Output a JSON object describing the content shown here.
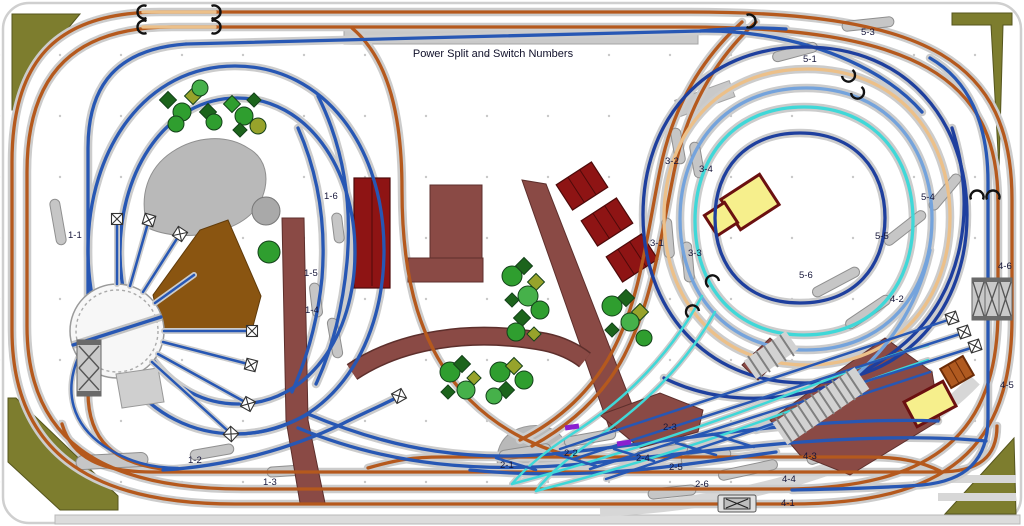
{
  "title": {
    "text": "Power Split and Switch Numbers"
  },
  "colors": {
    "orange": "#b5591d",
    "blue": "#2757b4",
    "dark_blue": "#1e3f9e",
    "tan": "#ecc089",
    "light_blue": "#74a3dc",
    "cyan": "#3fd8d8",
    "roadbed": "#cccccc",
    "olive": "#7d7d2e",
    "maroon": "#8a4a45",
    "dark_red": "#8e1414",
    "yellow": "#f6ef8c",
    "dirt": "#8a5511",
    "rock": "#b9b9b9",
    "tree_green": "#2f9e2f",
    "tree_dark": "#1c641c",
    "tree_olive": "#97a32b",
    "purple": "#8a1fd0",
    "label": "#16163a",
    "grid_dot": "#c8c8c8",
    "platform_gray": "#c6c6c6",
    "structure_gray": "#c9c9c9"
  },
  "switch_labels": [
    {
      "id": "1-1",
      "x": 68,
      "y": 238
    },
    {
      "id": "1-2",
      "x": 188,
      "y": 463
    },
    {
      "id": "1-3",
      "x": 263,
      "y": 485
    },
    {
      "id": "1-4",
      "x": 305,
      "y": 313
    },
    {
      "id": "1-5",
      "x": 304,
      "y": 276
    },
    {
      "id": "1-6",
      "x": 324,
      "y": 199
    },
    {
      "id": "2-1",
      "x": 500,
      "y": 468
    },
    {
      "id": "2-2",
      "x": 564,
      "y": 456
    },
    {
      "id": "2-3",
      "x": 663,
      "y": 430
    },
    {
      "id": "2-4",
      "x": 636,
      "y": 461
    },
    {
      "id": "2-5",
      "x": 669,
      "y": 470
    },
    {
      "id": "2-6",
      "x": 695,
      "y": 487
    },
    {
      "id": "3-1",
      "x": 650,
      "y": 246
    },
    {
      "id": "3-2",
      "x": 665,
      "y": 164
    },
    {
      "id": "3-3",
      "x": 688,
      "y": 256
    },
    {
      "id": "3-4",
      "x": 699,
      "y": 172
    },
    {
      "id": "4-1",
      "x": 781,
      "y": 506
    },
    {
      "id": "4-2",
      "x": 890,
      "y": 302
    },
    {
      "id": "4-3",
      "x": 803,
      "y": 459
    },
    {
      "id": "4-4",
      "x": 782,
      "y": 482
    },
    {
      "id": "4-5",
      "x": 1000,
      "y": 388
    },
    {
      "id": "4-6",
      "x": 998,
      "y": 269
    },
    {
      "id": "5-1",
      "x": 803,
      "y": 62
    },
    {
      "id": "5-3",
      "x": 861,
      "y": 35
    },
    {
      "id": "5-4",
      "x": 921,
      "y": 200
    },
    {
      "id": "5-5",
      "x": 875,
      "y": 239
    },
    {
      "id": "5-6",
      "x": 799,
      "y": 278
    }
  ]
}
